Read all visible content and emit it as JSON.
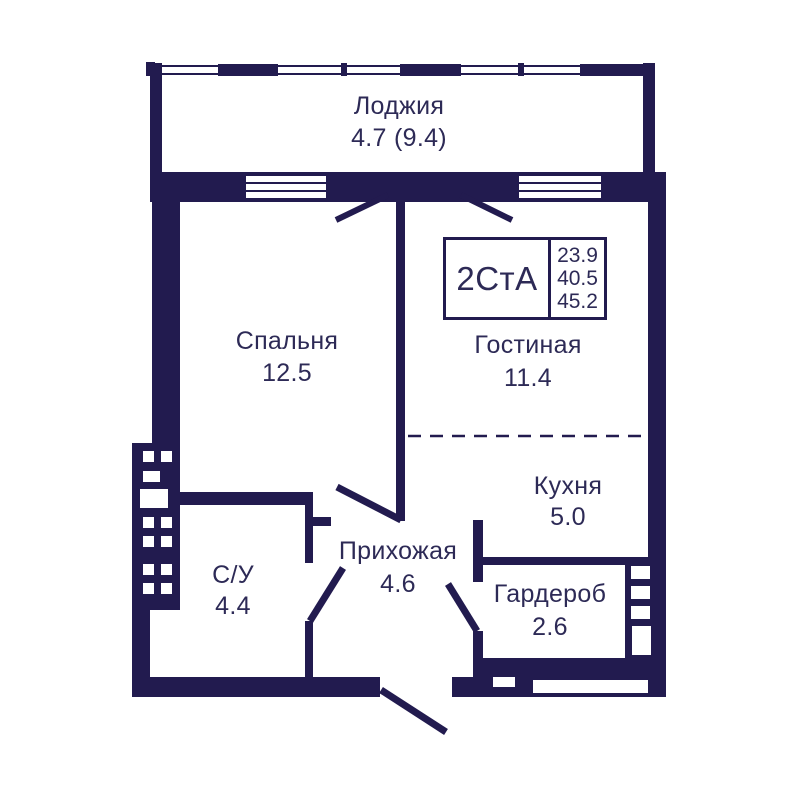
{
  "plan": {
    "title": "Apartment floor plan",
    "info_box": {
      "type_label": "2СтА",
      "areas": [
        "23.9",
        "40.5",
        "45.2"
      ]
    },
    "rooms": [
      {
        "id": "loggia",
        "name": "Лоджия",
        "area": "4.7 (9.4)"
      },
      {
        "id": "bedroom",
        "name": "Спальня",
        "area": "12.5"
      },
      {
        "id": "living",
        "name": "Гостиная",
        "area": "11.4"
      },
      {
        "id": "kitchen",
        "name": "Кухня",
        "area": "5.0"
      },
      {
        "id": "hallway",
        "name": "Прихожая",
        "area": "4.6"
      },
      {
        "id": "bathroom",
        "name": "С/У",
        "area": "4.4"
      },
      {
        "id": "wardrobe",
        "name": "Гардероб",
        "area": "2.6"
      }
    ],
    "colors": {
      "wall": "#221b4f",
      "text": "#2d2a56",
      "background": "#ffffff"
    }
  }
}
